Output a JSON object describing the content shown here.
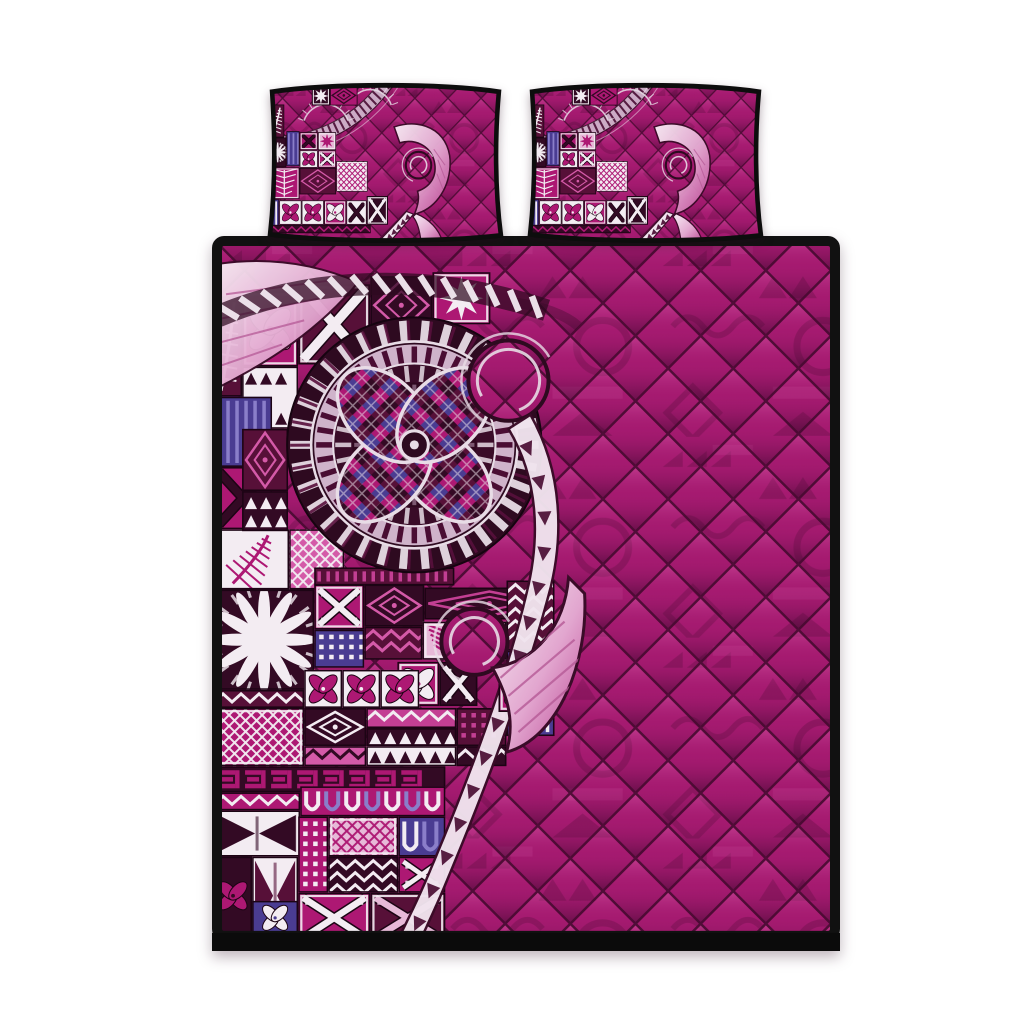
{
  "scene": {
    "description": "Product photo of a Polynesian tapa-print quilt bed set in magenta pink: two matching pillow shams above a large quilt, all with black piped edges, patchwork tapa blocks, a circular flower medallion and a koru fish-hook lash motif over diamond quilting",
    "canvas": {
      "width": 1024,
      "height": 1024,
      "background": "#ffffff"
    },
    "pieces": [
      {
        "id": "pillow-sham-left",
        "label": "pillow sham"
      },
      {
        "id": "pillow-sham-right",
        "label": "pillow sham"
      },
      {
        "id": "quilt",
        "label": "quilt"
      }
    ],
    "motifs": [
      "diamond quilting",
      "tapa patchwork blocks",
      "flower medallion",
      "koru curl",
      "fish-hook lash with chevrons",
      "fern leaf",
      "sunburst flower"
    ]
  },
  "artwork": {
    "palette": {
      "background": "#ffffff",
      "binding": "#111111",
      "base": "#a51a70",
      "baseLight": "#cb4f9d",
      "baseDark": "#5e0c40",
      "seam": "#45092f",
      "tribalDark": "#6d0f4a",
      "tribalLight": "#c34795",
      "mag": "#ad1873",
      "mag2": "#c33f93",
      "pink": "#d45aa8",
      "pinkL": "#e7b9d8",
      "white": "#f3ecf2",
      "maroon": "#330a24",
      "plum": "#571038",
      "indigo": "#4a3c92",
      "indigoL": "#8a7ec9",
      "silver": "#e8dce6",
      "silverD": "#cfb3ca",
      "hookA": "#f8eef5",
      "hookB": "#e2a6cf",
      "hookC": "#bb4392",
      "blockLine": "#1c0414",
      "chevron": "#4a0d33"
    },
    "quilt_blocks": [
      [
        30,
        55,
        56,
        75,
        "mag",
        "flower4",
        "pinkL",
        1
      ],
      [
        86,
        48,
        72,
        80,
        "plum",
        "cross",
        "white",
        1
      ],
      [
        158,
        40,
        62,
        58,
        "maroon",
        "diamonds",
        "pink",
        0
      ],
      [
        220,
        36,
        58,
        52,
        "mag",
        "star8",
        "white",
        1
      ],
      [
        30,
        130,
        56,
        62,
        "white",
        "arrows",
        "maroon",
        0
      ],
      [
        2,
        60,
        28,
        100,
        "plum",
        "fern",
        "white",
        0
      ],
      [
        2,
        160,
        58,
        70,
        "indigo",
        "bars",
        "indigoL",
        0
      ],
      [
        2,
        230,
        58,
        62,
        "mag",
        "cross",
        "maroon",
        0
      ],
      [
        2,
        292,
        75,
        60,
        "white",
        "fern",
        "mag",
        0
      ],
      [
        77,
        292,
        55,
        60,
        "pink",
        "lattice",
        "white",
        0
      ],
      [
        30,
        192,
        46,
        62,
        "plum",
        "diamonds",
        "pink",
        0
      ],
      [
        30,
        254,
        46,
        40,
        "maroon",
        "arrows",
        "white",
        0
      ],
      [
        102,
        330,
        140,
        18,
        "plum",
        "bars",
        "mag2",
        0
      ],
      [
        2,
        352,
        100,
        100,
        "maroon",
        "sunburst",
        "white",
        0
      ],
      [
        102,
        347,
        50,
        45,
        "mag",
        "cross",
        "white",
        1
      ],
      [
        102,
        392,
        50,
        38,
        "indigo",
        "dots",
        "white",
        0
      ],
      [
        152,
        347,
        60,
        42,
        "maroon",
        "diamonds",
        "pink",
        0
      ],
      [
        152,
        389,
        58,
        33,
        "plum",
        "chev",
        "pink",
        0
      ],
      [
        210,
        384,
        42,
        38,
        "pinkL",
        "leaf",
        "mag",
        1
      ],
      [
        212,
        350,
        130,
        32,
        "maroon",
        "diamonds",
        "mag2",
        0
      ],
      [
        252,
        384,
        42,
        38,
        "white",
        "leaf",
        "mag",
        1
      ],
      [
        294,
        343,
        48,
        70,
        "plum",
        "chev",
        "white",
        0
      ],
      [
        294,
        413,
        48,
        85,
        "indigo",
        "bars",
        "white",
        0
      ],
      [
        185,
        424,
        42,
        44,
        "mag",
        "flower4",
        "white",
        1
      ],
      [
        227,
        424,
        38,
        44,
        "maroon",
        "cross",
        "white",
        0
      ],
      [
        92,
        432,
        38,
        38,
        "white",
        "flower4",
        "mag",
        1
      ],
      [
        130,
        432,
        38,
        38,
        "white",
        "flower4",
        "mag",
        1
      ],
      [
        168,
        432,
        39,
        38,
        "white",
        "flower4",
        "mag",
        1
      ],
      [
        2,
        452,
        90,
        18,
        "plum",
        "chev",
        "white",
        0
      ],
      [
        2,
        470,
        90,
        58,
        "mag",
        "lattice",
        "white",
        1
      ],
      [
        92,
        470,
        62,
        38,
        "maroon",
        "diamonds",
        "white",
        0
      ],
      [
        92,
        508,
        62,
        20,
        "pink",
        "chev",
        "maroon",
        0
      ],
      [
        154,
        470,
        90,
        20,
        "mag2",
        "chev",
        "white",
        0
      ],
      [
        154,
        490,
        90,
        18,
        "maroon",
        "arrows",
        "white",
        0
      ],
      [
        154,
        508,
        90,
        20,
        "white",
        "arrows",
        "maroon",
        0
      ],
      [
        244,
        470,
        50,
        38,
        "plum",
        "dots",
        "mag2",
        0
      ],
      [
        244,
        508,
        50,
        20,
        "maroon",
        "chev",
        "white",
        0
      ],
      [
        2,
        528,
        231,
        26,
        "maroon",
        "ebar",
        "mag",
        0
      ],
      [
        2,
        554,
        86,
        18,
        "mag",
        "chev",
        "white",
        0
      ],
      [
        88,
        548,
        145,
        30,
        "mag",
        "urow",
        "white",
        0
      ],
      [
        2,
        572,
        86,
        46,
        "white",
        "bow",
        "maroon",
        1
      ],
      [
        2,
        618,
        38,
        78,
        "maroon",
        "flower4",
        "mag",
        0
      ],
      [
        40,
        618,
        46,
        78,
        "white",
        "bow",
        "plum",
        0
      ],
      [
        86,
        578,
        30,
        76,
        "mag",
        "dots",
        "white",
        0
      ],
      [
        116,
        578,
        70,
        40,
        "pinkL",
        "lattice",
        "mag",
        1
      ],
      [
        116,
        618,
        70,
        36,
        "maroon",
        "chev",
        "white",
        0
      ],
      [
        186,
        578,
        47,
        40,
        "indigo",
        "urow",
        "white",
        0
      ],
      [
        186,
        618,
        47,
        36,
        "mag",
        "cross",
        "white",
        0
      ],
      [
        86,
        654,
        72,
        50,
        "mag",
        "cross",
        "white",
        1
      ],
      [
        158,
        654,
        75,
        50,
        "plum",
        "cross",
        "pinkL",
        1
      ],
      [
        40,
        662,
        46,
        34,
        "indigo",
        "flower4",
        "white",
        0
      ],
      [
        2,
        696,
        231,
        12,
        "maroon",
        "arrows",
        "mag2",
        0
      ]
    ],
    "pillow_blocks": [
      [
        90,
        12,
        36,
        36,
        "maroon",
        "star8",
        "white",
        1
      ],
      [
        126,
        10,
        54,
        38,
        "mag",
        "diamonds",
        "maroon",
        0
      ],
      [
        6,
        46,
        30,
        62,
        "plum",
        "fern",
        "white",
        0
      ],
      [
        6,
        108,
        34,
        56,
        "maroon",
        "sunburst",
        "white",
        0
      ],
      [
        40,
        96,
        26,
        66,
        "indigo",
        "bars",
        "indigoL",
        0
      ],
      [
        66,
        98,
        36,
        34,
        "mag",
        "cross",
        "maroon",
        1
      ],
      [
        102,
        98,
        36,
        34,
        "pinkL",
        "star8",
        "mag",
        1
      ],
      [
        66,
        132,
        36,
        33,
        "white",
        "flower4",
        "mag",
        1
      ],
      [
        102,
        132,
        36,
        33,
        "mag",
        "cross",
        "white",
        1
      ],
      [
        66,
        165,
        72,
        50,
        "plum",
        "diamonds",
        "pink",
        0
      ],
      [
        138,
        152,
        62,
        58,
        "white",
        "lattice",
        "mag",
        1
      ],
      [
        6,
        164,
        60,
        60,
        "mag",
        "leaf",
        "white",
        1
      ],
      [
        6,
        224,
        20,
        64,
        "indigo",
        "bars",
        "white",
        0
      ],
      [
        26,
        226,
        44,
        46,
        "white",
        "flower4",
        "mag",
        1
      ],
      [
        70,
        226,
        44,
        46,
        "white",
        "flower4",
        "mag",
        1
      ],
      [
        114,
        226,
        44,
        46,
        "mag",
        "flower4",
        "white",
        1
      ],
      [
        158,
        226,
        40,
        46,
        "white",
        "cross",
        "maroon",
        1
      ],
      [
        198,
        218,
        42,
        54,
        "maroon",
        "cross",
        "white",
        1
      ],
      [
        6,
        272,
        200,
        16,
        "maroon",
        "chev",
        "mag",
        0
      ]
    ]
  }
}
